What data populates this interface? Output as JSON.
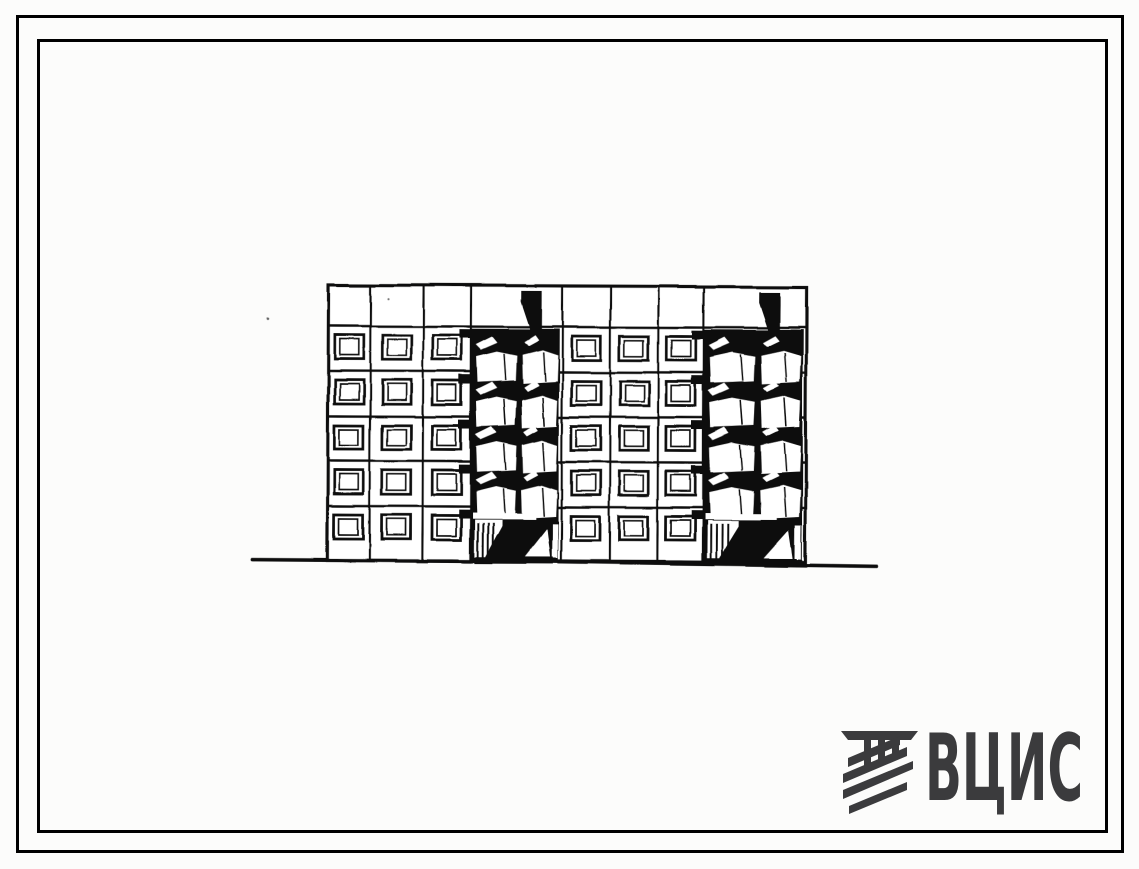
{
  "page": {
    "background": "#fcfcfb"
  },
  "frame": {
    "style": "double rectangular sheet frame",
    "border_color": "#000000"
  },
  "drawing": {
    "kind": "hand-inked architectural front elevation (scanned)",
    "subject": "Five-storey two-section large-panel apartment building with stacked loggias and ground-floor entrances",
    "ink_color": "#0f0f0f",
    "building": {
      "floors": 5,
      "sections": 2,
      "window_columns_per_section": 3,
      "window_rows": 5,
      "loggia_tiers_per_section": 4,
      "entrances": 2,
      "has_blank_parapet_band": true
    },
    "ground_line": true
  },
  "logo": {
    "text": "ВЦИС",
    "color": "#3b3b3d",
    "icon": "hatched-pillar-emblem"
  },
  "artifacts": {
    "specks": 2
  }
}
